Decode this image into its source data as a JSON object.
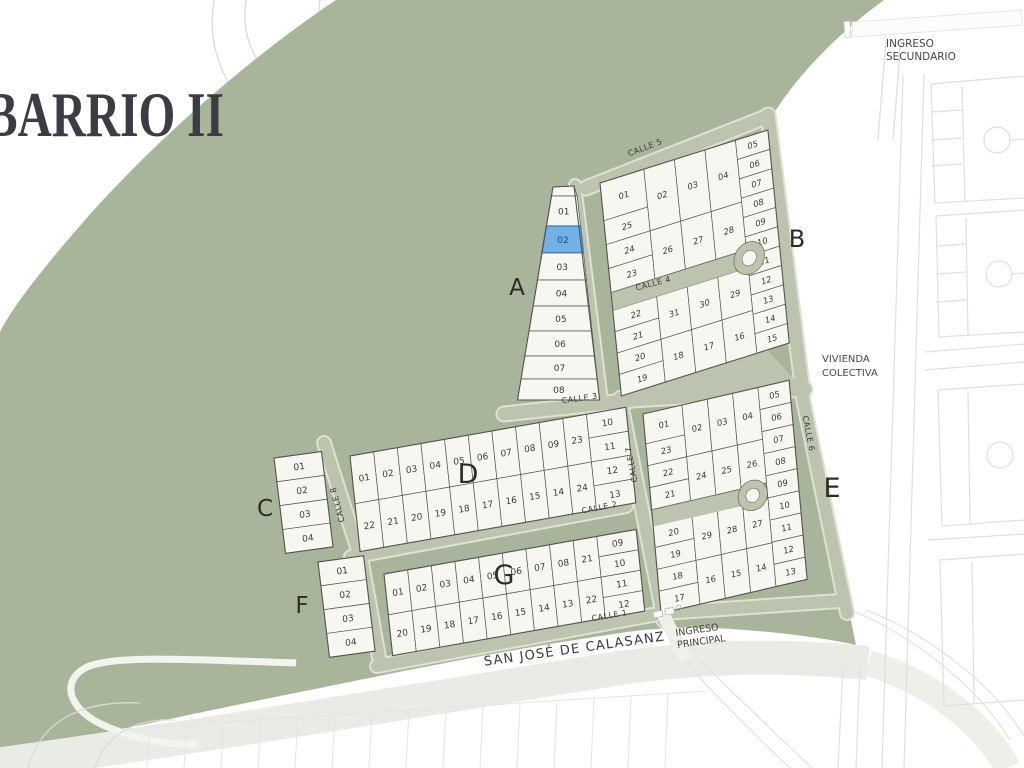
{
  "title": "BARRIO II",
  "map_labels": {
    "ingreso_secundario_line1": "INGRESO",
    "ingreso_secundario_line2": "SECUNDARIO",
    "ingreso_principal_line1": "INGRESO",
    "ingreso_principal_line2": "PRINCIPAL",
    "vivienda_colectiva_line1": "VIVIENDA",
    "vivienda_colectiva_line2": "COLECTIVA",
    "main_street": "SAN JOSÉ DE CALASANZ"
  },
  "streets": {
    "calle1": "CALLE 1",
    "calle2": "CALLE 2",
    "calle3": "CALLE 3",
    "calle4": "CALLE 4",
    "calle5": "CALLE 5",
    "calle6": "CALLE 6",
    "calle7": "CALLE 7",
    "calle8": "CALLE 8"
  },
  "colors": {
    "green_area": "#a9b59b",
    "street": "#bcc4af",
    "street_casing": "#dde2d2",
    "lot_fill": "#f7f7f2",
    "lot_outline": "#565650",
    "lot_number": "#3b3b33",
    "highlight_fill": "#74b0e5",
    "highlight_border": "#3a78b8",
    "highlight_text": "#1c4a7c",
    "faint_line": "#dfe0dc",
    "road_band": "#e9ebe5",
    "title_text": "#3c3c45",
    "label_text": "#3a3a35"
  },
  "blocks": {
    "A": {
      "label": "A",
      "lots": [
        "01",
        "02",
        "03",
        "04",
        "05",
        "06",
        "07",
        "08"
      ],
      "highlighted": "02"
    },
    "B": {
      "label": "B",
      "top_left": "01",
      "top_row": [
        "02",
        "03",
        "04"
      ],
      "left_col": [
        "25",
        "24",
        "23"
      ],
      "mid_upper": [
        "26",
        "27",
        "28"
      ],
      "right_col": [
        "05",
        "06",
        "07",
        "08",
        "09",
        "10",
        "11",
        "12",
        "13",
        "14",
        "15"
      ],
      "left_col_lower": [
        "22",
        "21",
        "20",
        "19"
      ],
      "mid_lower_top": [
        "31",
        "30",
        "29"
      ],
      "mid_lower_bottom": [
        "18",
        "17",
        "16"
      ]
    },
    "C": {
      "label": "C",
      "lots": [
        "01",
        "02",
        "03",
        "04"
      ]
    },
    "D": {
      "label": "D",
      "top_row": [
        "01",
        "02",
        "03",
        "04",
        "05",
        "06",
        "07",
        "08",
        "09",
        "23"
      ],
      "bottom_row": [
        "22",
        "21",
        "20",
        "19",
        "18",
        "17",
        "16",
        "15",
        "14",
        "24"
      ],
      "right_col": [
        "10",
        "11",
        "12",
        "13"
      ]
    },
    "E": {
      "label": "E",
      "top_left": "01",
      "top_row": [
        "02",
        "03",
        "04"
      ],
      "left_col": [
        "23",
        "22",
        "21"
      ],
      "mid_upper": [
        "24",
        "25",
        "26"
      ],
      "right_col": [
        "05",
        "06",
        "07",
        "08",
        "09",
        "10",
        "11",
        "12",
        "13"
      ],
      "left_col_lower": [
        "20",
        "19",
        "18",
        "17"
      ],
      "mid_lower_top": [
        "29",
        "28",
        "27"
      ],
      "mid_lower_bottom": [
        "16",
        "15",
        "14"
      ]
    },
    "F": {
      "label": "F",
      "lots": [
        "01",
        "02",
        "03",
        "04"
      ]
    },
    "G": {
      "label": "G",
      "top_row": [
        "01",
        "02",
        "03",
        "04",
        "05",
        "06",
        "07",
        "08",
        "21"
      ],
      "bottom_row": [
        "20",
        "19",
        "18",
        "17",
        "16",
        "15",
        "14",
        "13",
        "22"
      ],
      "right_col": [
        "09",
        "10",
        "11",
        "12"
      ]
    }
  }
}
